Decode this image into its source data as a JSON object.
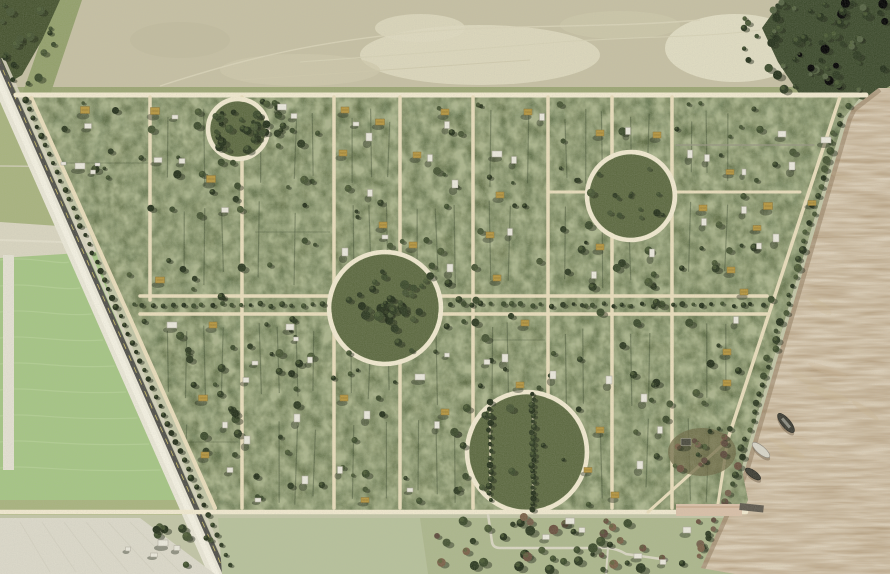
{
  "scene": {
    "kind": "satellite-aerial-photo",
    "description": "Aerial view of a planned forested settlement grid with circular plazas, bordered by a diagonal highway and farmland on the left, open field on top, and a brown river on the right",
    "width": 890,
    "height": 574
  },
  "palette": {
    "plot_green": "#5c6940",
    "plot_dark": "#222e14",
    "plot_light": "#97a263",
    "road_tan": "#e9ddbb",
    "road_bright": "#f1e9cf",
    "top_field": "#c6c0a3",
    "top_field_light": "#ded9bf",
    "scrub_green": "#93a06b",
    "woods_dark": "#46532f",
    "forest_dark": "#3c4a2c",
    "bright_field": "#a5c584",
    "bright_field_light": "#bcd69c",
    "pale_track": "#d9d5c0",
    "dirt_field": "#dcd9ca",
    "pasture": "#b7c19b",
    "bottom_field": "#c2c5a6",
    "water": "#b39c7c",
    "water_light": "#cbb795",
    "water_dark": "#8f7a5c",
    "highway_dark": "#4f4f49",
    "highway_stripe": "#d8c96a",
    "white_strip": "#eae7d7",
    "tree_greens": [
      "#2d3a21",
      "#3b4a2b",
      "#24301a",
      "#465433"
    ],
    "tree_browns": [
      "#6b5240",
      "#7a6148",
      "#5d4a3c",
      "#74604b"
    ],
    "tree_shadow": "#1c2414",
    "roof_white": "#eae8dc",
    "roof_gold": "#b6963f",
    "roof_dark": "#4a4a3e",
    "hedge": "#2f3d24",
    "gray_line": "#95937f",
    "dock_paving": "#d9c0a8",
    "pier": "#5e594e",
    "boat_dark": "#3c3c33",
    "boat_white": "#d8d5c8"
  },
  "map_features": {
    "plot": {
      "top_y": 95,
      "bottom_y": 512,
      "left_edge": {
        "x_at_top": 28,
        "slope": 0.448
      },
      "highway": {
        "x_at_top": 14,
        "slope": 0.441
      },
      "shoreline": {
        "x_at_110": 850,
        "slope_upper": 0.292,
        "y_bend": 470,
        "x_at_bend": 745,
        "slope_lower": 0.45
      },
      "vertical_roads": [
        150,
        242,
        334,
        400,
        473,
        548,
        612,
        672
      ],
      "vertical_road_150_max_y": 300,
      "avenue": {
        "y_top": 296,
        "y_bottom": 314,
        "x_start": 140,
        "median_tree_y": 305
      },
      "road_stubs": [
        {
          "y": 192,
          "x1": 548,
          "x2": 589
        },
        {
          "y": 192,
          "x1": 675,
          "x2": 800
        },
        {
          "y": 145,
          "x1": 676,
          "x2": 814,
          "gray": true
        }
      ],
      "corner_spur": [
        [
          728,
          440
        ],
        [
          648,
          512
        ]
      ],
      "top_road": {
        "y": 95,
        "x1": 16,
        "x2": 866
      },
      "bottom_road": {
        "y": 512,
        "x1": 0,
        "x2": 746
      }
    },
    "circular_plazas": [
      {
        "cx": 238,
        "cy": 129,
        "r": 30,
        "feature": "dense-tree-cluster"
      },
      {
        "cx": 631,
        "cy": 196,
        "r": 44,
        "feature": "scattered-trees"
      },
      {
        "cx": 385,
        "cy": 308,
        "r": 56,
        "feature": "dense-tree-cluster"
      },
      {
        "cx": 527,
        "cy": 452,
        "r": 60,
        "feature": "twin-tree-avenues"
      }
    ],
    "plaza4_tree_rows": [
      {
        "x": 490,
        "y1": 402,
        "y2": 500
      },
      {
        "x": 533,
        "y1": 394,
        "y2": 511
      }
    ],
    "buildings": [
      [
        85,
        110,
        9,
        7,
        "g"
      ],
      [
        88,
        126,
        7,
        5,
        "w"
      ],
      [
        80,
        166,
        10,
        6,
        "w"
      ],
      [
        93,
        172,
        5,
        4,
        "w"
      ],
      [
        155,
        111,
        9,
        7,
        "g"
      ],
      [
        175,
        117,
        6,
        4,
        "w"
      ],
      [
        158,
        160,
        8,
        5,
        "w"
      ],
      [
        182,
        161,
        6,
        5,
        "w"
      ],
      [
        211,
        179,
        9,
        7,
        "g"
      ],
      [
        225,
        210,
        7,
        5,
        "w"
      ],
      [
        160,
        280,
        9,
        6,
        "g"
      ],
      [
        172,
        325,
        10,
        6,
        "w"
      ],
      [
        213,
        325,
        8,
        6,
        "g"
      ],
      [
        282,
        107,
        9,
        6,
        "w"
      ],
      [
        294,
        116,
        6,
        5,
        "w"
      ],
      [
        290,
        327,
        8,
        6,
        "w"
      ],
      [
        296,
        339,
        5,
        4,
        "w"
      ],
      [
        255,
        363,
        6,
        4,
        "w"
      ],
      [
        310,
        360,
        5,
        6,
        "w"
      ],
      [
        345,
        252,
        6,
        8,
        "w"
      ],
      [
        345,
        110,
        8,
        6,
        "g"
      ],
      [
        356,
        124,
        6,
        4,
        "w"
      ],
      [
        380,
        122,
        9,
        6,
        "g"
      ],
      [
        369,
        137,
        6,
        8,
        "w"
      ],
      [
        343,
        153,
        8,
        6,
        "g"
      ],
      [
        445,
        112,
        8,
        6,
        "g"
      ],
      [
        447,
        125,
        5,
        7,
        "w"
      ],
      [
        417,
        155,
        8,
        6,
        "g"
      ],
      [
        430,
        158,
        5,
        7,
        "w"
      ],
      [
        455,
        184,
        6,
        8,
        "w"
      ],
      [
        370,
        193,
        5,
        7,
        "w"
      ],
      [
        383,
        225,
        8,
        6,
        "g"
      ],
      [
        385,
        237,
        6,
        4,
        "w"
      ],
      [
        413,
        245,
        8,
        6,
        "g"
      ],
      [
        528,
        112,
        8,
        6,
        "g"
      ],
      [
        542,
        117,
        5,
        7,
        "w"
      ],
      [
        497,
        154,
        10,
        6,
        "w"
      ],
      [
        514,
        160,
        5,
        7,
        "w"
      ],
      [
        500,
        195,
        8,
        6,
        "g"
      ],
      [
        490,
        235,
        8,
        6,
        "g"
      ],
      [
        510,
        232,
        5,
        7,
        "w"
      ],
      [
        450,
        268,
        6,
        8,
        "w"
      ],
      [
        497,
        278,
        8,
        6,
        "g"
      ],
      [
        525,
        323,
        8,
        6,
        "g"
      ],
      [
        487,
        362,
        6,
        5,
        "w"
      ],
      [
        505,
        358,
        6,
        8,
        "w"
      ],
      [
        447,
        355,
        5,
        4,
        "w"
      ],
      [
        600,
        133,
        8,
        6,
        "g"
      ],
      [
        628,
        131,
        5,
        7,
        "w"
      ],
      [
        657,
        135,
        8,
        6,
        "g"
      ],
      [
        690,
        154,
        5,
        8,
        "w"
      ],
      [
        707,
        158,
        5,
        7,
        "w"
      ],
      [
        730,
        172,
        8,
        5,
        "g"
      ],
      [
        744,
        172,
        4,
        6,
        "w"
      ],
      [
        703,
        208,
        8,
        6,
        "g"
      ],
      [
        744,
        210,
        5,
        7,
        "w"
      ],
      [
        704,
        222,
        5,
        7,
        "w"
      ],
      [
        600,
        247,
        8,
        6,
        "g"
      ],
      [
        652,
        253,
        5,
        8,
        "w"
      ],
      [
        594,
        275,
        5,
        7,
        "w"
      ],
      [
        731,
        270,
        8,
        6,
        "g"
      ],
      [
        757,
        228,
        8,
        5,
        "g"
      ],
      [
        782,
        134,
        8,
        6,
        "w"
      ],
      [
        826,
        140,
        10,
        6,
        "w"
      ],
      [
        792,
        166,
        6,
        8,
        "w"
      ],
      [
        768,
        206,
        9,
        7,
        "g"
      ],
      [
        812,
        203,
        8,
        5,
        "g"
      ],
      [
        776,
        238,
        6,
        8,
        "w"
      ],
      [
        759,
        246,
        5,
        6,
        "w"
      ],
      [
        744,
        292,
        8,
        6,
        "g"
      ],
      [
        736,
        320,
        5,
        7,
        "w"
      ],
      [
        727,
        352,
        8,
        6,
        "g"
      ],
      [
        203,
        398,
        9,
        6,
        "g"
      ],
      [
        247,
        440,
        6,
        8,
        "w"
      ],
      [
        297,
        418,
        6,
        8,
        "w"
      ],
      [
        367,
        415,
        6,
        8,
        "w"
      ],
      [
        344,
        398,
        8,
        6,
        "g"
      ],
      [
        420,
        377,
        10,
        6,
        "w"
      ],
      [
        445,
        412,
        8,
        6,
        "g"
      ],
      [
        437,
        425,
        5,
        7,
        "w"
      ],
      [
        520,
        385,
        8,
        6,
        "g"
      ],
      [
        553,
        375,
        6,
        8,
        "w"
      ],
      [
        609,
        380,
        6,
        8,
        "w"
      ],
      [
        644,
        398,
        6,
        8,
        "w"
      ],
      [
        727,
        383,
        8,
        6,
        "g"
      ],
      [
        205,
        455,
        8,
        6,
        "g"
      ],
      [
        230,
        470,
        6,
        5,
        "w"
      ],
      [
        258,
        500,
        6,
        4,
        "w"
      ],
      [
        305,
        480,
        6,
        8,
        "w"
      ],
      [
        340,
        470,
        5,
        7,
        "w"
      ],
      [
        365,
        500,
        8,
        5,
        "g"
      ],
      [
        410,
        490,
        6,
        4,
        "w"
      ],
      [
        588,
        470,
        8,
        5,
        "g"
      ],
      [
        640,
        465,
        6,
        8,
        "w"
      ],
      [
        615,
        495,
        8,
        6,
        "g"
      ],
      [
        660,
        430,
        5,
        7,
        "w"
      ],
      [
        600,
        430,
        8,
        6,
        "g"
      ],
      [
        246,
        380,
        6,
        5,
        "w"
      ],
      [
        225,
        425,
        5,
        6,
        "w"
      ],
      [
        686,
        442,
        10,
        7,
        "d"
      ]
    ],
    "houses_south": [
      [
        570,
        521,
        9,
        6
      ],
      [
        582,
        530,
        6,
        5
      ],
      [
        546,
        537,
        7,
        5
      ],
      [
        638,
        556,
        8,
        5
      ],
      [
        687,
        530,
        8,
        6
      ],
      [
        663,
        562,
        6,
        5
      ]
    ],
    "farmstead_buildings": [
      [
        163,
        543,
        10,
        6
      ],
      [
        177,
        548,
        6,
        5
      ],
      [
        154,
        555,
        7,
        4
      ],
      [
        128,
        549,
        5,
        4
      ]
    ],
    "vehicles": [
      [
        61,
        162
      ],
      [
        95,
        163
      ]
    ],
    "dock": {
      "plaza": [
        676,
        504,
        66,
        12
      ],
      "pier": [
        740,
        503,
        24,
        7
      ]
    },
    "boats": [
      {
        "x": 753,
        "y": 474,
        "rx": 9,
        "ry": 3.5,
        "rot": 35,
        "type": "dark"
      },
      {
        "x": 761,
        "y": 450,
        "rx": 11,
        "ry": 4,
        "rot": 40,
        "type": "white"
      },
      {
        "x": 786,
        "y": 423,
        "rx": 12,
        "ry": 4.5,
        "rot": 50,
        "type": "barge"
      }
    ],
    "access_road_south": "M 488,514 L 492,542 Q 493,548 500,548 L 608,548 Q 618,549 626,554 L 668,560",
    "access_road_spur": "M 608,548 L 606,574",
    "pale_track_left": [
      [
        0,
        222
      ],
      [
        88,
        228
      ],
      [
        96,
        252
      ],
      [
        0,
        258
      ]
    ],
    "left_canal": [
      3,
      255,
      11,
      215
    ],
    "garden_patch": {
      "cx": 702,
      "cy": 452,
      "rx": 34,
      "ry": 24
    },
    "generation": {
      "seed": 1337,
      "scatter_trees": 235,
      "forest_trees": 60,
      "woods_trees": 18,
      "bottom_trees": 48,
      "farm_trees": 10,
      "circle1_trees": 26,
      "circle2_trees": 11,
      "circle3_trees": 28,
      "hedge_spacing": 18,
      "median_tree_step": 10,
      "highway_tree_step": 9,
      "shore_tree_step": 9
    }
  }
}
